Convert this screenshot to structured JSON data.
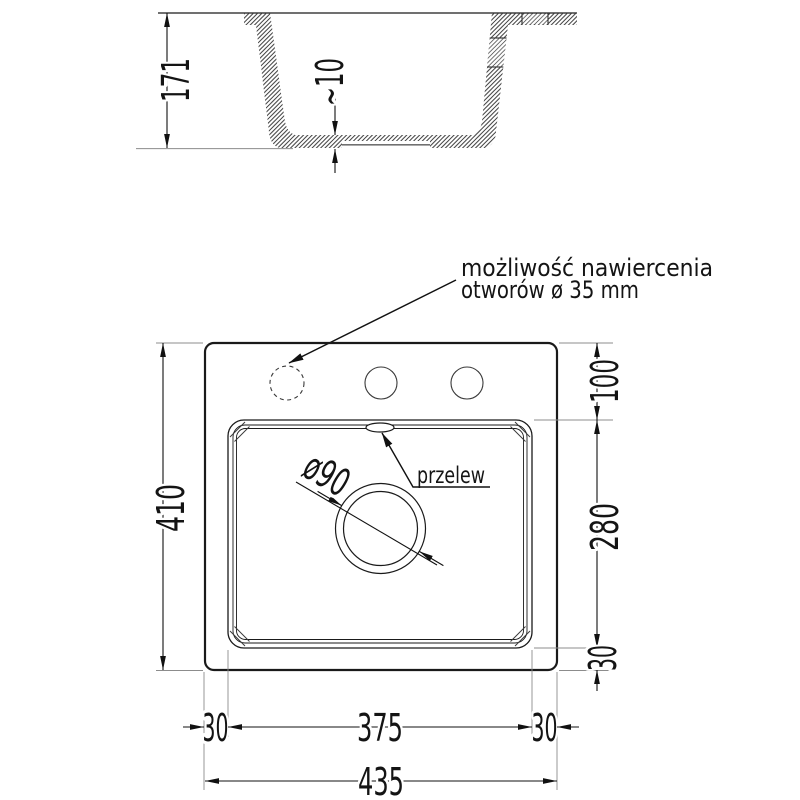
{
  "section_view": {
    "height_label": "171",
    "bottom_thickness_label": "~10"
  },
  "plan_view": {
    "overall_height_label": "410",
    "overall_width_label": "435",
    "holes_offset_label": "100",
    "bowl_length_label": "280",
    "bowl_bottom_margin_label": "30",
    "bowl_left_margin_label": "30",
    "bowl_width_label": "375",
    "bowl_right_margin_label": "30",
    "overflow_label": "przelew",
    "drain_diameter_label": "ø90"
  },
  "annotation": {
    "line1": "możliwość nawiercenia",
    "line2": "otworów ø 35 mm"
  },
  "colors": {
    "line": "#1a1a1a",
    "extension_line": "#8c8c8c",
    "background": "#ffffff"
  }
}
